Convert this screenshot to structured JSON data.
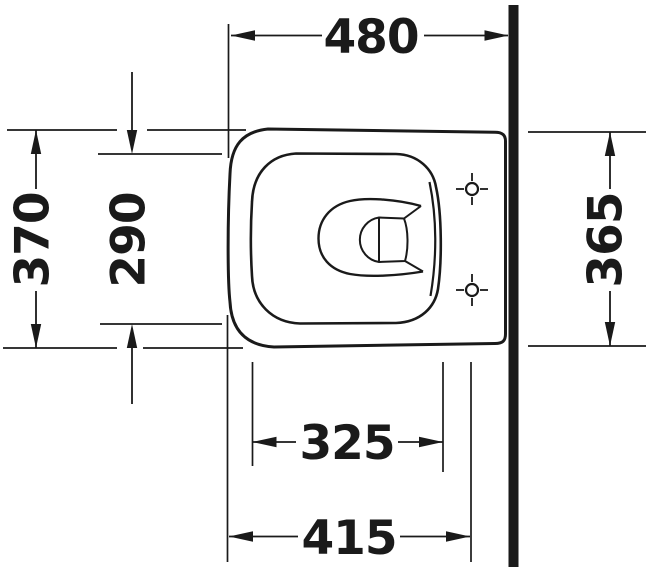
{
  "drawing": {
    "ink_color": "#1a1a1a",
    "background_color": "#ffffff",
    "labels": {
      "top_overall_depth": "480",
      "left_overall_width": "370",
      "left_rim_inner_width": "290",
      "right_rear_width": "365",
      "bottom_rim_inner_length": "325",
      "bottom_front_to_fixing": "415"
    }
  }
}
